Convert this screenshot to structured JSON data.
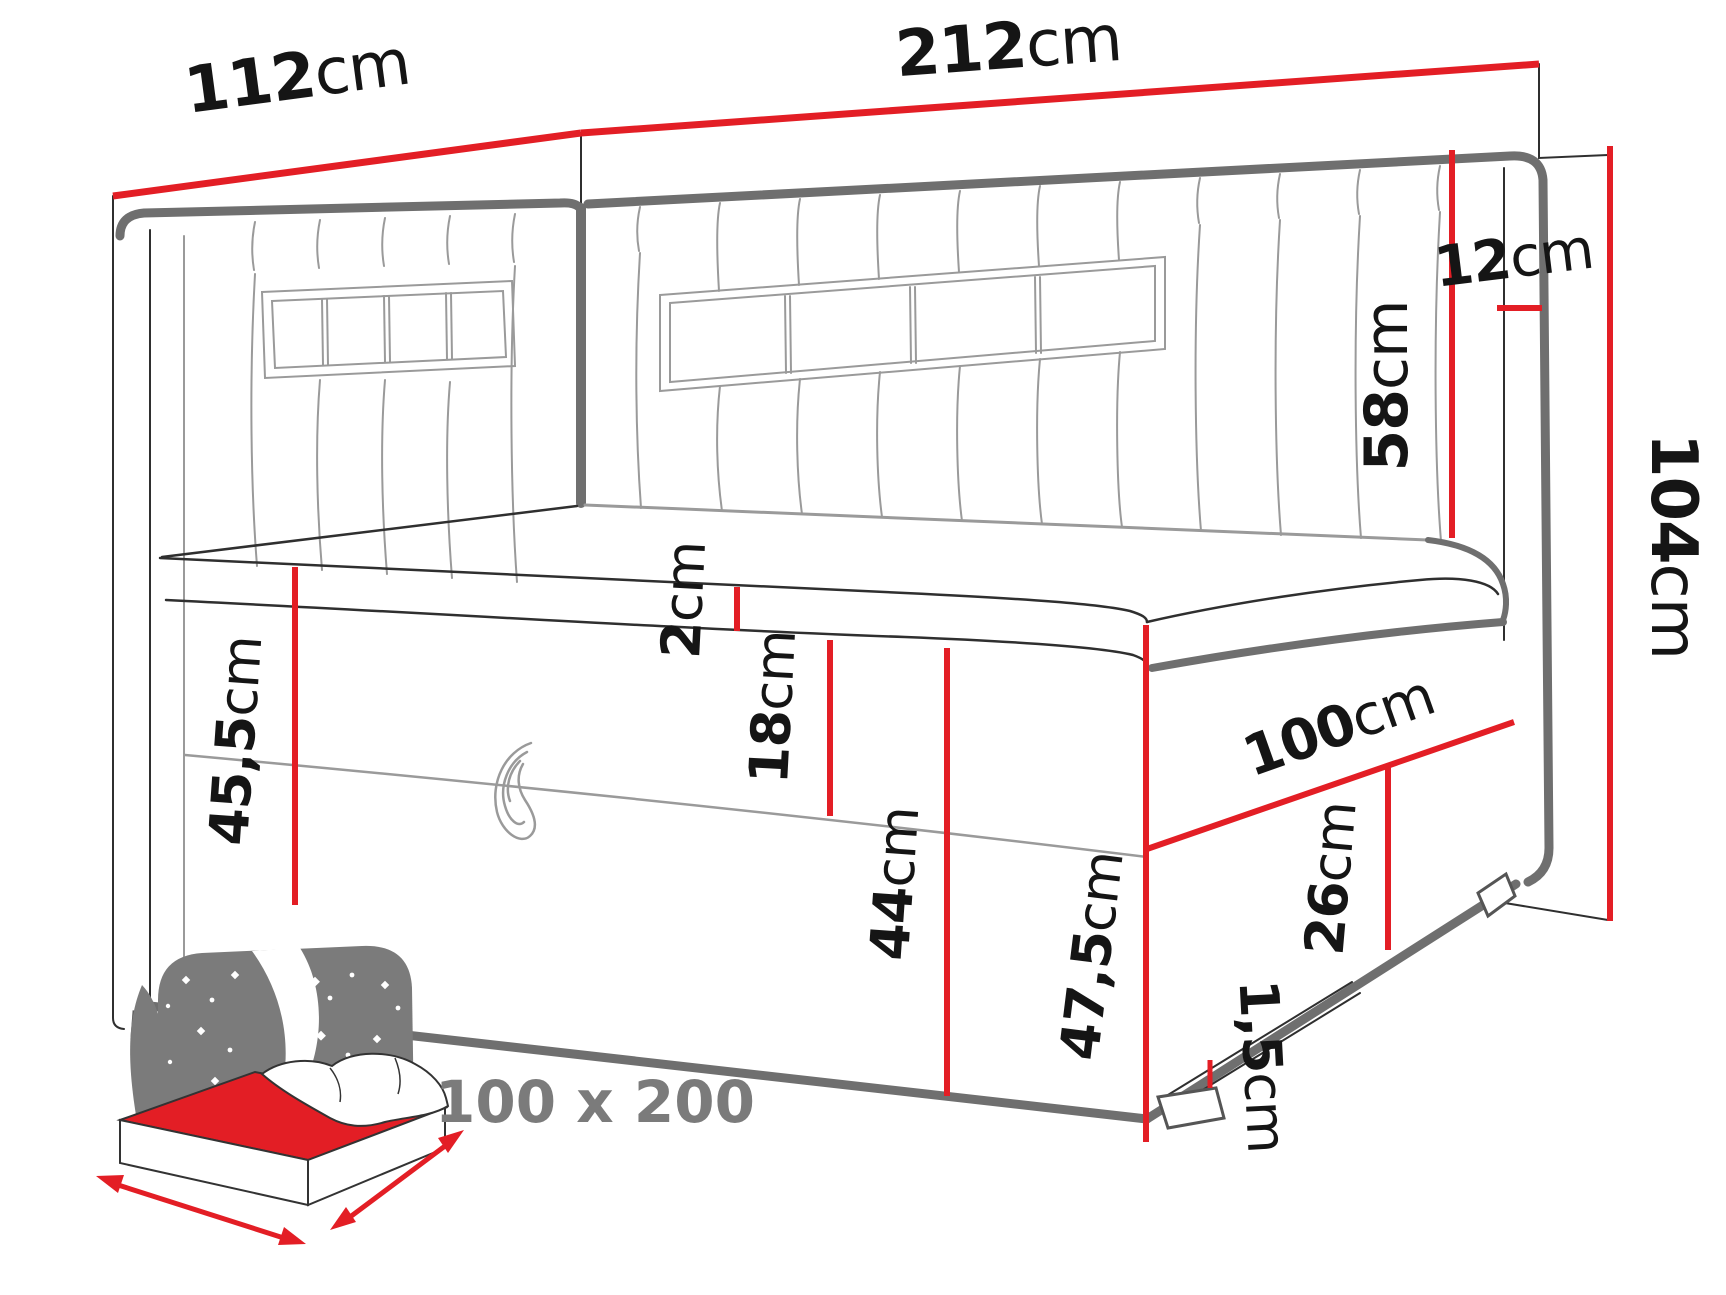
{
  "title": "Corner bed technical dimension diagram",
  "colors": {
    "red": "#e31e25",
    "thick": "#6f6f6f",
    "thin": "#2f2f2f",
    "seam": "#9a9a9a",
    "icongray": "#7b7b7b",
    "text": "#151515"
  },
  "dims": {
    "d112": {
      "num": "112",
      "unit": "cm"
    },
    "d212": {
      "num": "212",
      "unit": "cm"
    },
    "d58": {
      "num": "58",
      "unit": "cm"
    },
    "d12": {
      "num": "12",
      "unit": "cm"
    },
    "d104": {
      "num": "104",
      "unit": "cm"
    },
    "d2": {
      "num": "2",
      "unit": "cm"
    },
    "d18": {
      "num": "18",
      "unit": "cm"
    },
    "d45_5": {
      "num": "45,5",
      "unit": "cm"
    },
    "d44": {
      "num": "44",
      "unit": "cm"
    },
    "d100": {
      "num": "100",
      "unit": "cm"
    },
    "d26": {
      "num": "26",
      "unit": "cm"
    },
    "d47_5": {
      "num": "47,5",
      "unit": "cm"
    },
    "d1_5": {
      "num": "1,5",
      "unit": "cm"
    }
  },
  "icon": {
    "size_label": "100 x 200"
  }
}
